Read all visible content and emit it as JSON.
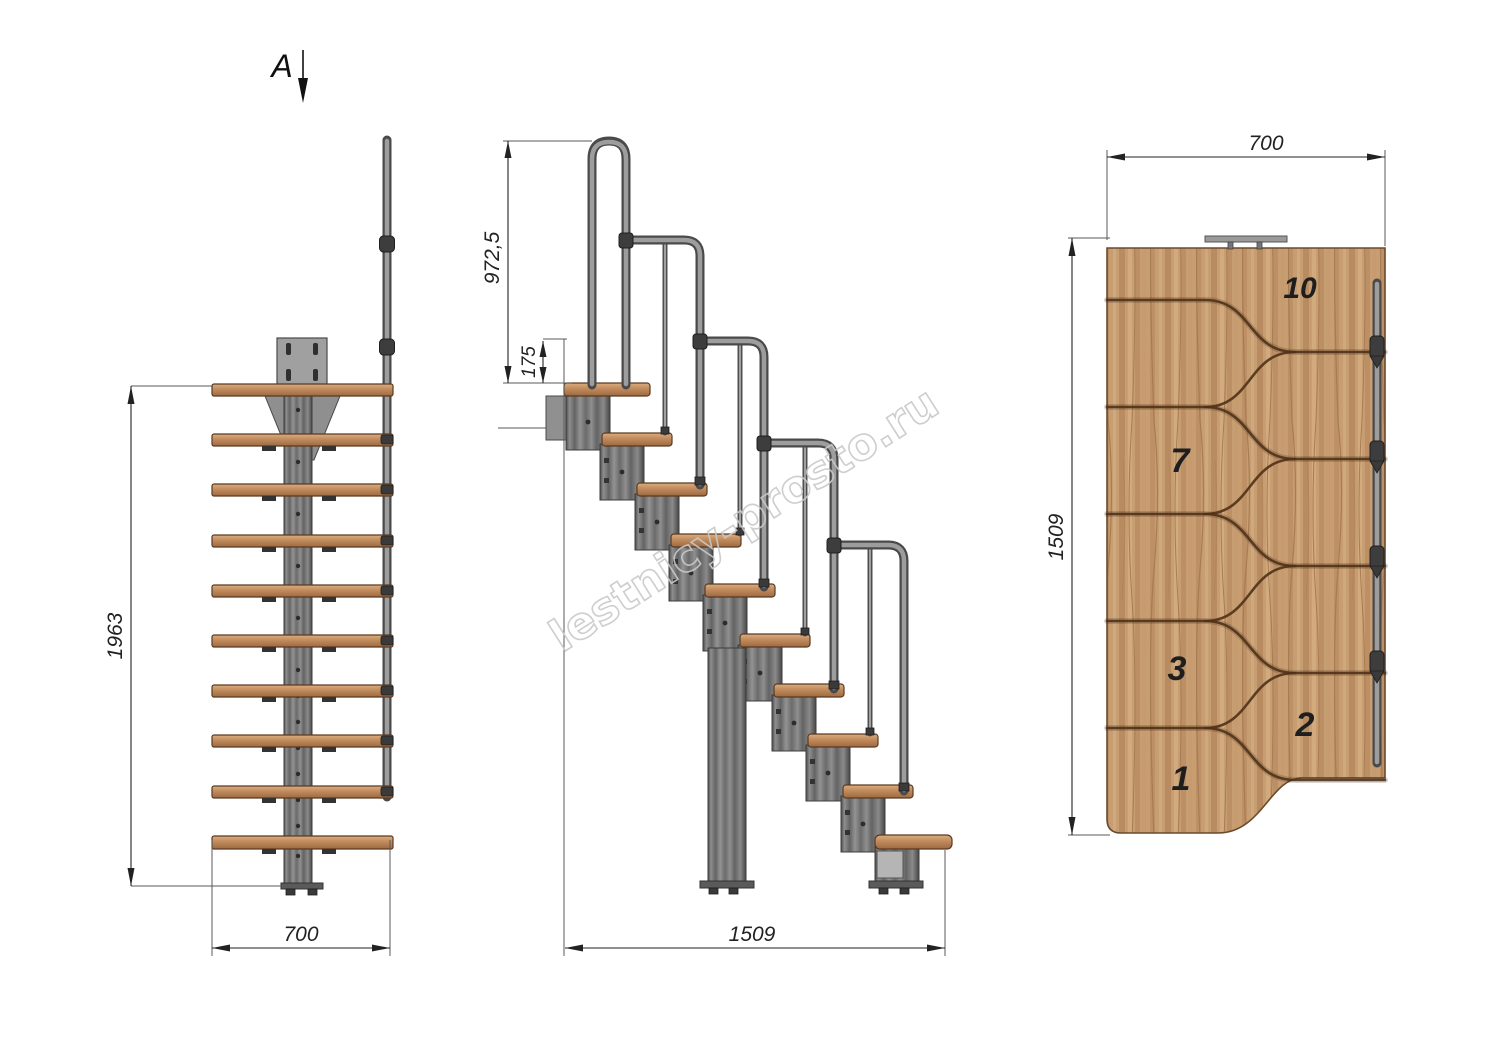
{
  "section": {
    "label": "A"
  },
  "watermark": {
    "text": "lestnicy-prosto.ru"
  },
  "views": {
    "front": {
      "dim_height_mm": "1963",
      "dim_width_mm": "700"
    },
    "side": {
      "dim_handrail_height_mm": "972,5",
      "dim_top_step_drop_mm": "175",
      "dim_run_length_mm": "1509"
    },
    "plan": {
      "dim_width_mm": "700",
      "dim_length_mm": "1509",
      "step_numbers": [
        "10",
        "7",
        "3",
        "2",
        "1"
      ]
    }
  },
  "colors": {
    "background": "#ffffff",
    "dim": "#222222",
    "watermark": "#c9c9c9",
    "wood": "#c79d72",
    "wood-line": "#503218",
    "metal": "#7c7c7c"
  }
}
